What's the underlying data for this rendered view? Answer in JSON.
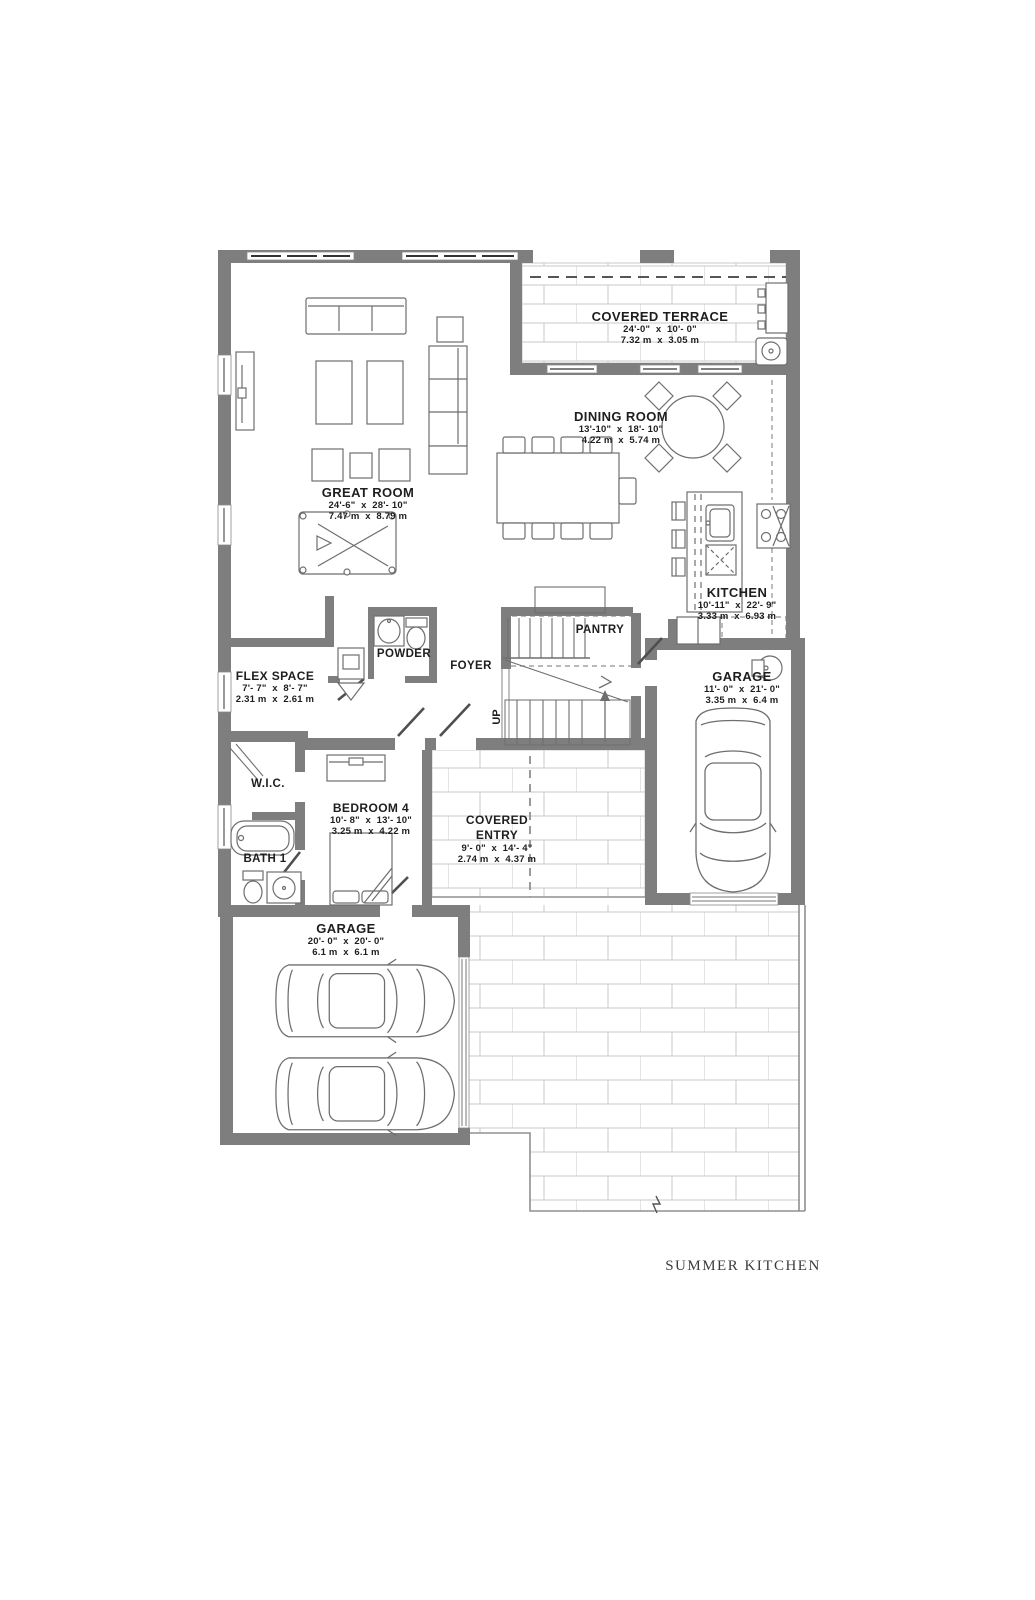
{
  "colors": {
    "wall": "#7e7e7e",
    "line": "#6e6e6e",
    "tile_line": "#c9c9c9",
    "dash": "#8f8f8f",
    "text": "#1e1e1e"
  },
  "footer": {
    "summer_kitchen": "SUMMER KITCHEN"
  },
  "rooms": {
    "covered_terrace": {
      "name": "COVERED TERRACE",
      "dim_ft": "24'-0\"  x  10'- 0\"",
      "dim_m": "7.32 m  x  3.05 m"
    },
    "great_room": {
      "name": "GREAT ROOM",
      "dim_ft": "24'-6\"  x  28'- 10\"",
      "dim_m": "7.47 m  x  8.79 m"
    },
    "dining_room": {
      "name": "DINING ROOM",
      "dim_ft": "13'-10\"  x  18'- 10\"",
      "dim_m": "4.22 m  x  5.74 m"
    },
    "kitchen": {
      "name": "KITCHEN",
      "dim_ft": "10'-11\"  x  22'- 9\"",
      "dim_m": "3.33 m  x  6.93 m"
    },
    "garage_right": {
      "name": "GARAGE",
      "dim_ft": "11'- 0\"  x  21'- 0\"",
      "dim_m": "3.35 m  x  6.4 m"
    },
    "garage_rear": {
      "name": "GARAGE",
      "dim_ft": "20'- 0\"  x  20'- 0\"",
      "dim_m": "6.1 m  x  6.1 m"
    },
    "flex_space": {
      "name": "FLEX SPACE",
      "dim_ft": "7'- 7\"  x  8'- 7\"",
      "dim_m": "2.31 m  x  2.61 m"
    },
    "bedroom_4": {
      "name": "BEDROOM 4",
      "dim_ft": "10'- 8\"  x  13'- 10\"",
      "dim_m": "3.25 m  x  4.22 m"
    },
    "covered_entry": {
      "name": "COVERED ENTRY",
      "dim_ft": "9'- 0\"  x  14'- 4\"",
      "dim_m": "2.74 m  x  4.37 m"
    },
    "pantry": {
      "name": "PANTRY"
    },
    "foyer": {
      "name": "FOYER"
    },
    "powder": {
      "name": "POWDER"
    },
    "wic": {
      "name": "W.I.C."
    },
    "bath_1": {
      "name": "BATH 1"
    },
    "stairs": {
      "up": "UP"
    }
  }
}
